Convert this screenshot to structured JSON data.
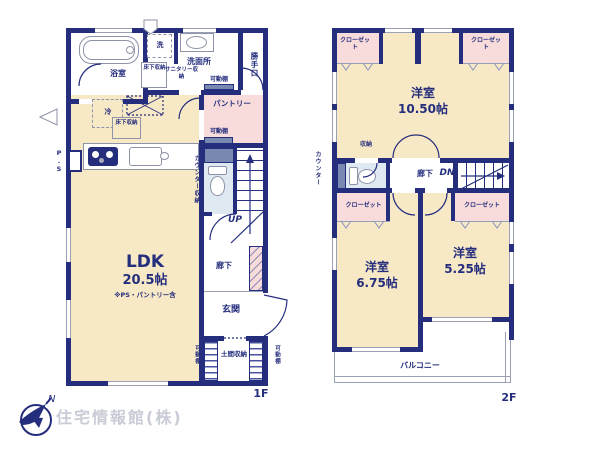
{
  "plan": {
    "f1": {
      "tag": "1F",
      "bath": "浴室",
      "laundry": "洗",
      "washroom": "洗面所",
      "underfloor_storage": "床下収納",
      "sanitary_storage": "サニタリー収納",
      "movable_shelf": "可動棚",
      "back_door": "勝手口",
      "fridge": "冷",
      "pantry": "パントリー",
      "counter_storage": "カウンター収納",
      "pipe_space": "P.S",
      "ldk": "LDK",
      "ldk_size": "20.5帖",
      "ldk_note": "※PS・パントリー含",
      "hallway": "廊下",
      "up": "UP",
      "entrance": "玄関",
      "doma_storage": "土間収納"
    },
    "f2": {
      "tag": "2F",
      "closet": "クローゼット",
      "western_room": "洋室",
      "room_main_size": "10.50帖",
      "room_left_size": "6.75帖",
      "room_right_size": "5.25帖",
      "counter": "カウンター",
      "storage": "収納",
      "hallway": "廊下",
      "dn": "DN",
      "balcony": "バルコニー"
    }
  },
  "footer": {
    "brand": "住宅情報館(株)",
    "compass_n": "N"
  },
  "colors": {
    "wall": "#252e7d",
    "cream": "#f7e8c6",
    "pink": "#f8dcdc",
    "blue": "#dfe9f2",
    "slate": "#7888b0",
    "line": "#9aa0b5",
    "watermark": "#c9ccd6"
  }
}
